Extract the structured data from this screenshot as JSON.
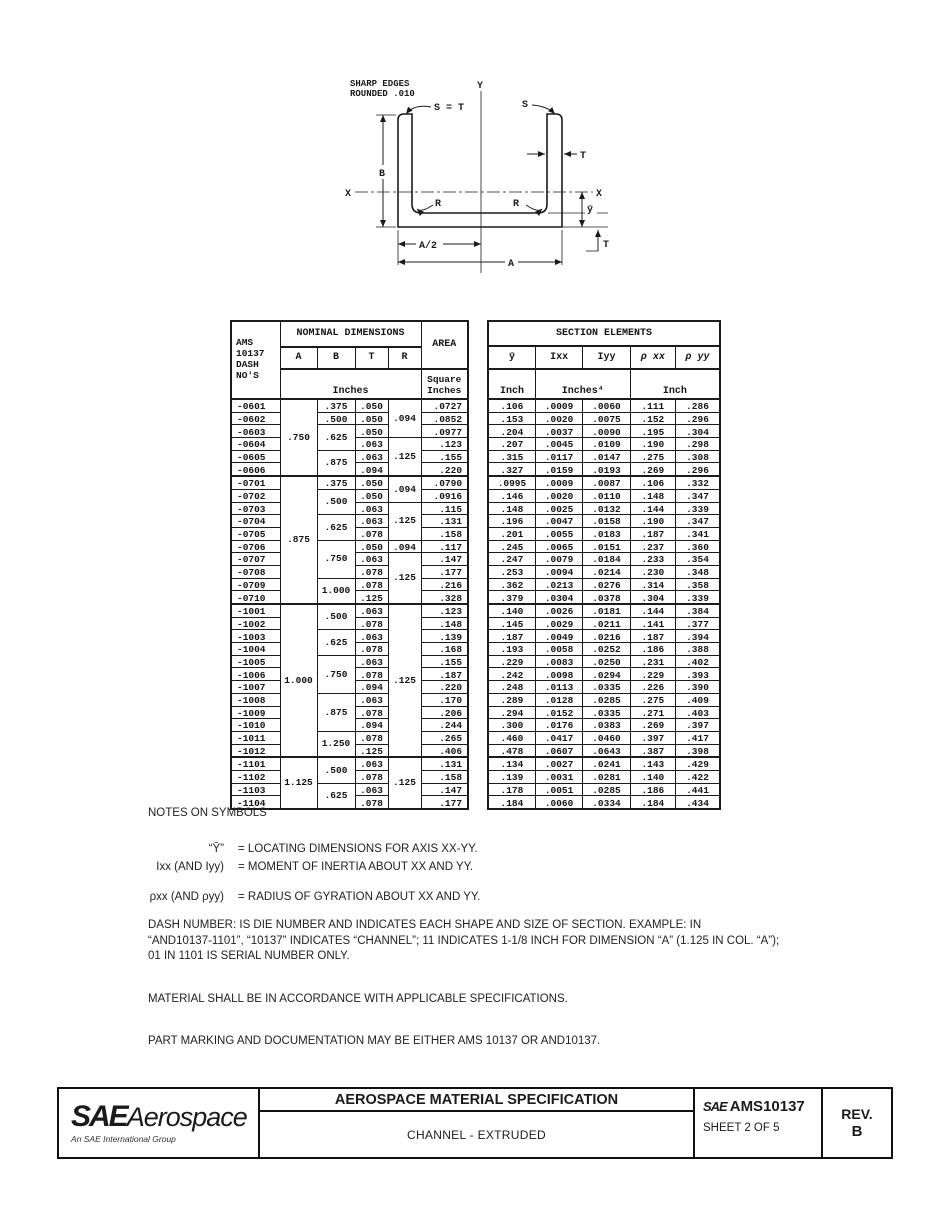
{
  "drawing": {
    "note_line1": "SHARP EDGES",
    "note_line2": "ROUNDED .010",
    "labels": {
      "y_axis": "Y",
      "x_left": "X",
      "x_right": "X",
      "b": "B",
      "t_wall": "T",
      "t_flange": "T",
      "s_eq_t": "S = T",
      "s": "S",
      "r_left": "R",
      "r_right": "R",
      "ybar": "ȳ",
      "a_half": "A/2",
      "a": "A"
    }
  },
  "left_table": {
    "header": {
      "dash": "AMS\n10137\nDASH\nNO'S",
      "nominal": "NOMINAL DIMENSIONS",
      "area": "AREA",
      "col_a": "A",
      "col_b": "B",
      "col_t": "T",
      "col_r": "R",
      "units": "Inches",
      "area_units": "Square\nInches"
    },
    "rows": [
      {
        "dash": "-0601",
        "A": {
          "v": ".750",
          "span": 6
        },
        "B": ".375",
        "T": ".050",
        "R": {
          "v": ".094",
          "span": 3
        },
        "area": ".0727"
      },
      {
        "dash": "-0602",
        "B": ".500",
        "T": ".050",
        "area": ".0852"
      },
      {
        "dash": "-0603",
        "B": {
          "v": ".625",
          "span": 2
        },
        "T": ".050",
        "area": ".0977"
      },
      {
        "dash": "-0604",
        "T": ".063",
        "R": {
          "v": ".125",
          "span": 3
        },
        "area": ".123"
      },
      {
        "dash": "-0605",
        "B": {
          "v": ".875",
          "span": 2
        },
        "T": ".063",
        "area": ".155"
      },
      {
        "dash": "-0606",
        "T": ".094",
        "area": ".220"
      },
      {
        "dash": "-0701",
        "group": true,
        "A": {
          "v": ".875",
          "span": 10
        },
        "B": ".375",
        "T": ".050",
        "R": {
          "v": ".094",
          "span": 2
        },
        "area": ".0790"
      },
      {
        "dash": "-0702",
        "B": {
          "v": ".500",
          "span": 2
        },
        "T": ".050",
        "area": ".0916"
      },
      {
        "dash": "-0703",
        "T": ".063",
        "R": {
          "v": ".125",
          "span": 3
        },
        "area": ".115"
      },
      {
        "dash": "-0704",
        "B": {
          "v": ".625",
          "span": 2
        },
        "T": ".063",
        "area": ".131"
      },
      {
        "dash": "-0705",
        "T": ".078",
        "area": ".158"
      },
      {
        "dash": "-0706",
        "B": {
          "v": ".750",
          "span": 3
        },
        "T": ".050",
        "R": ".094",
        "area": ".117"
      },
      {
        "dash": "-0707",
        "T": ".063",
        "R": {
          "v": ".125",
          "span": 4
        },
        "area": ".147"
      },
      {
        "dash": "-0708",
        "T": ".078",
        "area": ".177"
      },
      {
        "dash": "-0709",
        "B": {
          "v": "1.000",
          "span": 2
        },
        "T": ".078",
        "area": ".216"
      },
      {
        "dash": "-0710",
        "T": ".125",
        "area": ".328"
      },
      {
        "dash": "-1001",
        "group": true,
        "A": {
          "v": "1.000",
          "span": 12
        },
        "B": {
          "v": ".500",
          "span": 2
        },
        "T": ".063",
        "R": {
          "v": ".125",
          "span": 12
        },
        "area": ".123"
      },
      {
        "dash": "-1002",
        "T": ".078",
        "area": ".148"
      },
      {
        "dash": "-1003",
        "B": {
          "v": ".625",
          "span": 2
        },
        "T": ".063",
        "area": ".139"
      },
      {
        "dash": "-1004",
        "T": ".078",
        "area": ".168"
      },
      {
        "dash": "-1005",
        "B": {
          "v": ".750",
          "span": 3
        },
        "T": ".063",
        "area": ".155"
      },
      {
        "dash": "-1006",
        "T": ".078",
        "area": ".187"
      },
      {
        "dash": "-1007",
        "T": ".094",
        "area": ".220"
      },
      {
        "dash": "-1008",
        "B": {
          "v": ".875",
          "span": 3
        },
        "T": ".063",
        "area": ".170"
      },
      {
        "dash": "-1009",
        "T": ".078",
        "area": ".206"
      },
      {
        "dash": "-1010",
        "T": ".094",
        "area": ".244"
      },
      {
        "dash": "-1011",
        "B": {
          "v": "1.250",
          "span": 2
        },
        "T": ".078",
        "area": ".265"
      },
      {
        "dash": "-1012",
        "T": ".125",
        "area": ".406"
      },
      {
        "dash": "-1101",
        "group": true,
        "A": {
          "v": "1.125",
          "span": 4
        },
        "B": {
          "v": ".500",
          "span": 2
        },
        "T": ".063",
        "R": {
          "v": ".125",
          "span": 4
        },
        "area": ".131"
      },
      {
        "dash": "-1102",
        "T": ".078",
        "area": ".158"
      },
      {
        "dash": "-1103",
        "B": {
          "v": ".625",
          "span": 2
        },
        "T": ".063",
        "area": ".147"
      },
      {
        "dash": "-1104",
        "T": ".078",
        "area": ".177"
      }
    ]
  },
  "right_table": {
    "title": "SECTION ELEMENTS",
    "col_ybar": "ȳ",
    "col_ixx": "Ixx",
    "col_iyy": "Iyy",
    "col_rxx": "ρ xx",
    "col_ryy": "ρ yy",
    "unit_ybar": "Inch",
    "unit_i": "Inches⁴",
    "unit_rho": "Inch",
    "group_starts": [
      6,
      16,
      28
    ],
    "rows": [
      [
        ".106",
        ".0009",
        ".0060",
        ".111",
        ".286"
      ],
      [
        ".153",
        ".0020",
        ".0075",
        ".152",
        ".296"
      ],
      [
        ".204",
        ".0037",
        ".0090",
        ".195",
        ".304"
      ],
      [
        ".207",
        ".0045",
        ".0109",
        ".190",
        ".298"
      ],
      [
        ".315",
        ".0117",
        ".0147",
        ".275",
        ".308"
      ],
      [
        ".327",
        ".0159",
        ".0193",
        ".269",
        ".296"
      ],
      [
        ".0995",
        ".0009",
        ".0087",
        ".106",
        ".332"
      ],
      [
        ".146",
        ".0020",
        ".0110",
        ".148",
        ".347"
      ],
      [
        ".148",
        ".0025",
        ".0132",
        ".144",
        ".339"
      ],
      [
        ".196",
        ".0047",
        ".0158",
        ".190",
        ".347"
      ],
      [
        ".201",
        ".0055",
        ".0183",
        ".187",
        ".341"
      ],
      [
        ".245",
        ".0065",
        ".0151",
        ".237",
        ".360"
      ],
      [
        ".247",
        ".0079",
        ".0184",
        ".233",
        ".354"
      ],
      [
        ".253",
        ".0094",
        ".0214",
        ".230",
        ".348"
      ],
      [
        ".362",
        ".0213",
        ".0276",
        ".314",
        ".358"
      ],
      [
        ".379",
        ".0304",
        ".0378",
        ".304",
        ".339"
      ],
      [
        ".140",
        ".0026",
        ".0181",
        ".144",
        ".384"
      ],
      [
        ".145",
        ".0029",
        ".0211",
        ".141",
        ".377"
      ],
      [
        ".187",
        ".0049",
        ".0216",
        ".187",
        ".394"
      ],
      [
        ".193",
        ".0058",
        ".0252",
        ".186",
        ".388"
      ],
      [
        ".229",
        ".0083",
        ".0250",
        ".231",
        ".402"
      ],
      [
        ".242",
        ".0098",
        ".0294",
        ".229",
        ".393"
      ],
      [
        ".248",
        ".0113",
        ".0335",
        ".226",
        ".390"
      ],
      [
        ".289",
        ".0128",
        ".0285",
        ".275",
        ".409"
      ],
      [
        ".294",
        ".0152",
        ".0335",
        ".271",
        ".403"
      ],
      [
        ".300",
        ".0176",
        ".0383",
        ".269",
        ".397"
      ],
      [
        ".460",
        ".0417",
        ".0460",
        ".397",
        ".417"
      ],
      [
        ".478",
        ".0607",
        ".0643",
        ".387",
        ".398"
      ],
      [
        ".134",
        ".0027",
        ".0241",
        ".143",
        ".429"
      ],
      [
        ".139",
        ".0031",
        ".0281",
        ".140",
        ".422"
      ],
      [
        ".178",
        ".0051",
        ".0285",
        ".186",
        ".441"
      ],
      [
        ".184",
        ".0060",
        ".0334",
        ".184",
        ".434"
      ]
    ]
  },
  "notes": {
    "heading": "NOTES ON SYMBOLS",
    "symbols": [
      {
        "term": "“Ȳ”",
        "def": "= LOCATING DIMENSIONS FOR AXIS XX-YY."
      },
      {
        "term": "Ixx (AND Iyy)",
        "def": "= MOMENT OF INERTIA ABOUT XX AND YY."
      },
      {
        "term": "ρxx (AND ρyy)",
        "def": "= RADIUS OF GYRATION ABOUT XX AND YY."
      }
    ],
    "para_dash": "DASH NUMBER:  IS DIE NUMBER AND INDICATES EACH SHAPE AND SIZE OF SECTION.  EXAMPLE:  IN\n“AND10137-1101”, “10137” INDICATES “CHANNEL”; 11 INDICATES 1-1/8 INCH FOR DIMENSION “A” (1.125 IN COL. “A”);\n01 IN 1101 IS SERIAL NUMBER ONLY.",
    "para_material": "MATERIAL SHALL BE IN ACCORDANCE WITH APPLICABLE SPECIFICATIONS.",
    "para_marking": "PART MARKING AND DOCUMENTATION MAY BE EITHER AMS 10137 OR AND10137."
  },
  "footer": {
    "logo_sae": "SAE",
    "logo_aerospace": "Aerospace",
    "logo_tagline": "An SAE International Group",
    "title": "AEROSPACE MATERIAL SPECIFICATION",
    "subtitle": "CHANNEL - EXTRUDED",
    "doc_sae": "SAE",
    "doc_number": "AMS10137",
    "doc_sheet": "SHEET 2 OF 5",
    "rev_label": "REV.",
    "rev_value": "B"
  }
}
